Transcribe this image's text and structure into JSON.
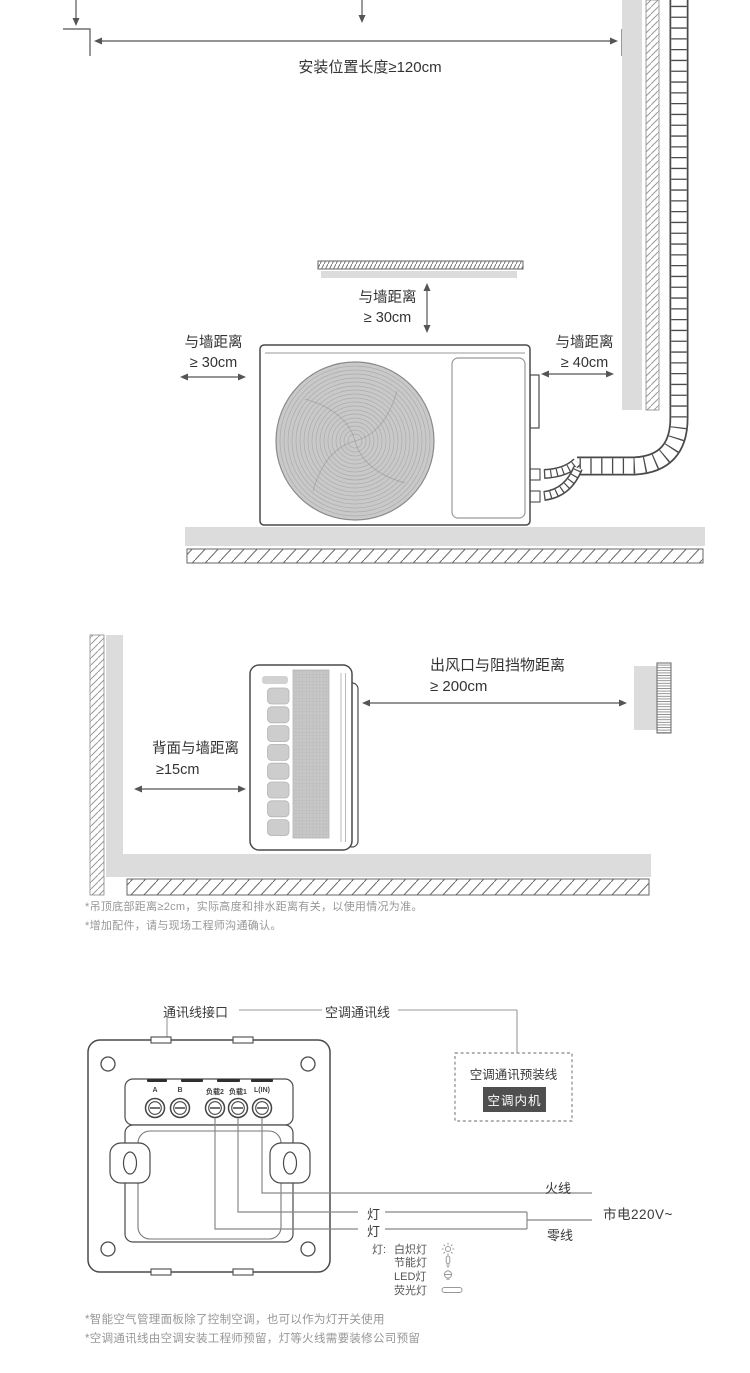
{
  "colors": {
    "line": "#4a4a4a",
    "dim_line": "#555555",
    "fill_gray": "#dcdcdc",
    "fan_gray": "#c9c9c9",
    "text": "#333333",
    "note_text": "#979797",
    "badge_bg": "#4f4f4f",
    "badge_text": "#ffffff"
  },
  "outdoor_section": {
    "install_length_label": "安装位置长度≥120cm",
    "top_clearance": {
      "line1": "与墙距离",
      "line2": "≥ 30cm"
    },
    "left_clearance": {
      "line1": "与墙距离",
      "line2": "≥ 30cm"
    },
    "right_clearance": {
      "line1": "与墙距离",
      "line2": "≥ 40cm"
    }
  },
  "indoor_section": {
    "back_clearance": {
      "line1": "背面与墙距离",
      "line2": "≥15cm"
    },
    "outlet_clearance": {
      "line1": "出风口与阻挡物距离",
      "line2": "≥ 200cm"
    },
    "notes": [
      "*吊顶底部距离≥2cm，实际高度和排水距离有关，以使用情况为准。",
      "*增加配件，请与现场工程师沟通确认。"
    ]
  },
  "wiring_section": {
    "comm_interface_label": "通讯线接口",
    "comm_line_label": "空调通讯线",
    "preinstalled_label": "空调通讯预装线",
    "indoor_unit_badge": "空调内机",
    "live_wire_label": "火线",
    "neutral_wire_label": "零线",
    "mains_label": "市电220V~",
    "lamp_label_1": "灯",
    "lamp_label_2": "灯",
    "terminals": [
      "A",
      "B",
      "负载2",
      "负载1",
      "L(IN)"
    ],
    "legend": {
      "prefix": "灯:",
      "items": [
        {
          "label": "白炽灯",
          "icon": "incandescent-icon"
        },
        {
          "label": "节能灯",
          "icon": "cfl-icon"
        },
        {
          "label": "LED灯",
          "icon": "led-bulb-icon"
        },
        {
          "label": "荧光灯",
          "icon": "fluorescent-tube-icon"
        }
      ]
    },
    "notes": [
      "*智能空气管理面板除了控制空调，也可以作为灯开关使用",
      "*空调通讯线由空调安装工程师预留，灯等火线需要装修公司预留"
    ]
  }
}
